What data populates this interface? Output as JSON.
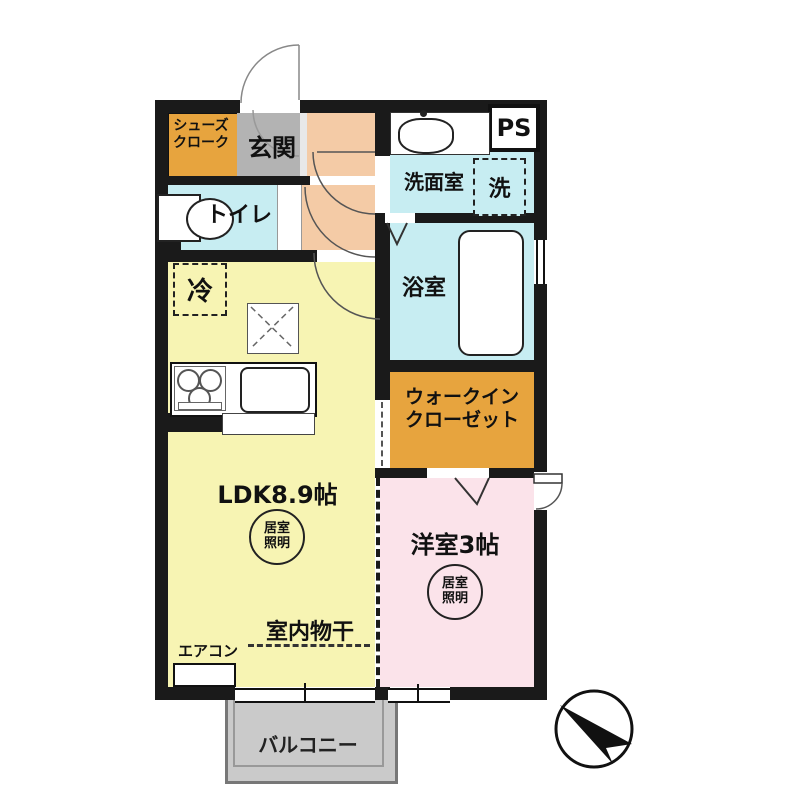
{
  "colors": {
    "wall": "#1a1a1a",
    "closet-orange": "#e7a43e",
    "entrance-gray": "#b3b3b3",
    "hallway-peach": "#f4cba6",
    "wet-cyan": "#c7edf2",
    "ldk-yellow": "#f7f4b3",
    "bedroom-pink": "#fbe3ea",
    "balcony-gray": "#cacaca"
  },
  "rooms": {
    "shoe_closet": {
      "line1": "シューズ",
      "line2": "クローク"
    },
    "entrance": {
      "label": "玄関"
    },
    "toilet": {
      "label": "トイレ"
    },
    "washroom": {
      "label": "洗面室"
    },
    "washer": {
      "label": "洗"
    },
    "pipe_space": {
      "label": "PS"
    },
    "bathroom": {
      "label": "浴室"
    },
    "refrigerator": {
      "label": "冷"
    },
    "ldk": {
      "label": "LDK8.9帖"
    },
    "walk_in_closet": {
      "line1": "ウォークイン",
      "line2": "クローゼット"
    },
    "western_room": {
      "label": "洋室3帖"
    },
    "balcony": {
      "label": "バルコニー"
    }
  },
  "annotations": {
    "room_light": {
      "line1": "居室",
      "line2": "照明"
    },
    "indoor_drying": {
      "label": "室内物干"
    },
    "air_conditioner": {
      "label": "エアコン"
    }
  },
  "icons": {
    "compass": "north-arrow",
    "toilet_symbol": "toilet-tank-and-bowl",
    "vanity_symbol": "wash-basin",
    "bathtub_symbol": "bathtub",
    "stove_symbol": "three-burner-stove",
    "kitchen_sink_symbol": "kitchen-sink",
    "ceiling_symbol": "dashed-x-hatch",
    "door_symbol": "quarter-circle-door-swing"
  }
}
